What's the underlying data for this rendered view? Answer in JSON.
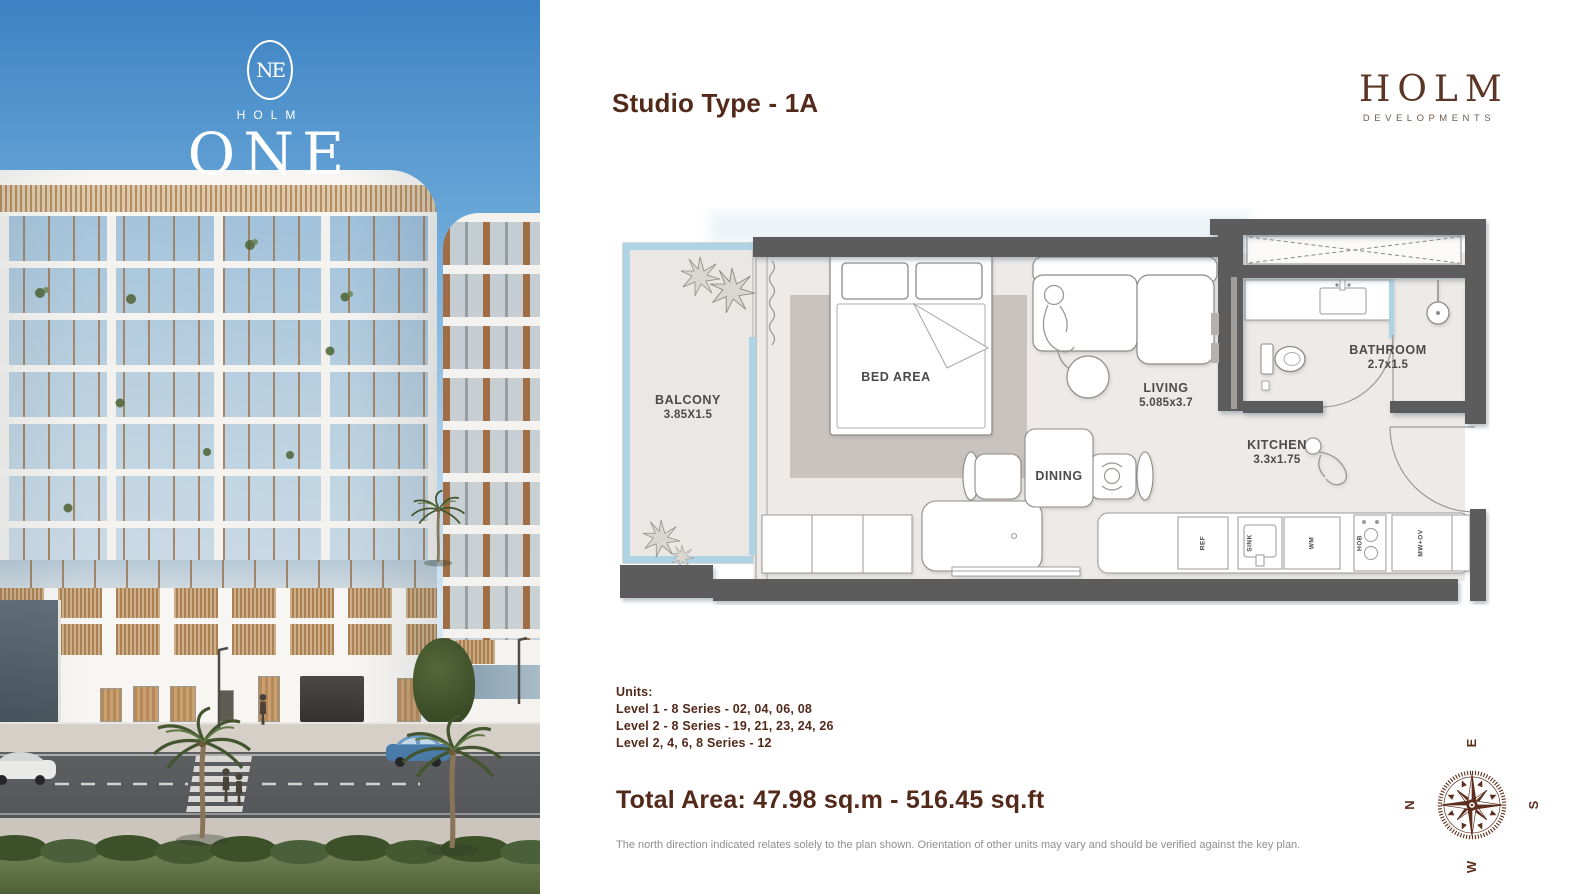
{
  "brand": {
    "name": "HOLM",
    "tagline": "DEVELOPMENTS"
  },
  "photo": {
    "monogram": "NE",
    "logo_name": "HOLM",
    "logo_word": "ONE"
  },
  "header": {
    "title": "Studio Type - 1A"
  },
  "floorplan": {
    "rooms": {
      "balcony": {
        "label": "BALCONY",
        "dims": "3.85X1.5"
      },
      "bed": {
        "label": "BED AREA"
      },
      "living": {
        "label": "LIVING",
        "dims": "5.085x3.7"
      },
      "dining": {
        "label": "DINING"
      },
      "kitchen": {
        "label": "KITCHEN",
        "dims": "3.3x1.75"
      },
      "bathroom": {
        "label": "BATHROOM",
        "dims": "2.7x1.5"
      }
    },
    "appliances": [
      "REF",
      "SINK",
      "WM",
      "HOB",
      "MW+OV"
    ]
  },
  "units": {
    "heading": "Units:",
    "lines": [
      "Level 1 - 8 Series - 02, 04, 06, 08",
      "Level 2 - 8 Series - 19, 21, 23, 24, 26",
      "Level 2, 4, 6, 8 Series - 12"
    ]
  },
  "total_area": "Total Area: 47.98 sq.m - 516.45 sq.ft",
  "disclaimer": "The north direction indicated relates solely to the plan shown. Orientation of other units may vary and should be verified against the key plan.",
  "compass": {
    "n": "N",
    "e": "E",
    "s": "S",
    "w": "W"
  },
  "colors": {
    "accent_brown": "#5a3223",
    "wall_gray": "#5b5b5b",
    "floor_gray": "#edeae7",
    "rug_gray": "#c9c3bf",
    "balcony_blue": "#aed3e2",
    "sky_blue": "#4287c6"
  }
}
